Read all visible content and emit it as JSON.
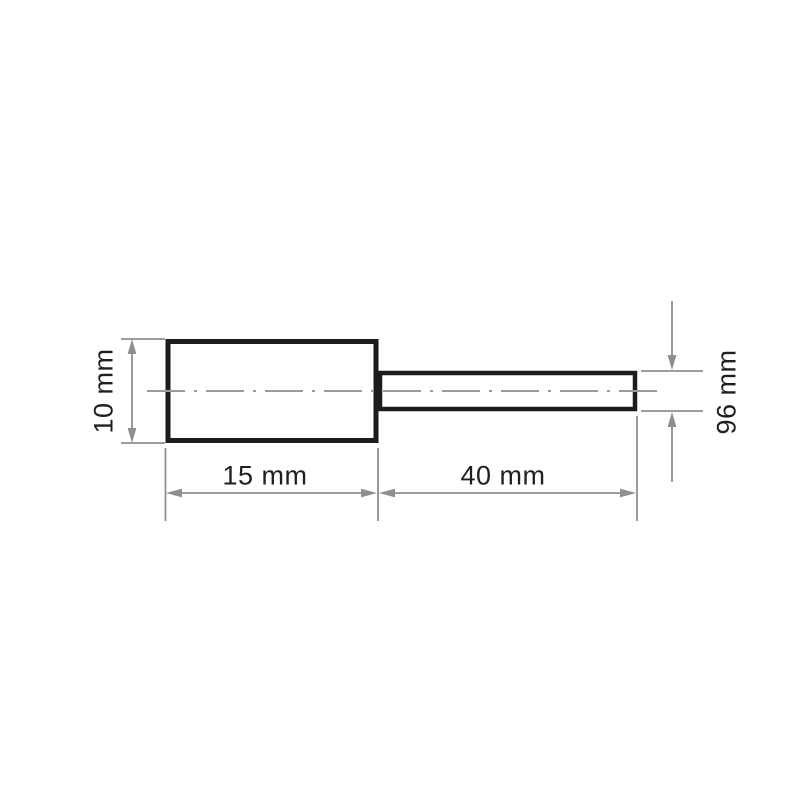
{
  "drawing": {
    "title": "cylindrical-mounted-point-dimension-drawing",
    "labels": {
      "body_diameter": "10 mm",
      "body_length": "15 mm",
      "shank_length": "40 mm",
      "shank_diameter": "96 mm"
    },
    "colors": {
      "outline": "#1c1c1c",
      "dimension": "#8f8f8f",
      "centerline": "#9a9a9a",
      "text": "#1f1f1f",
      "background": "#ffffff"
    }
  }
}
